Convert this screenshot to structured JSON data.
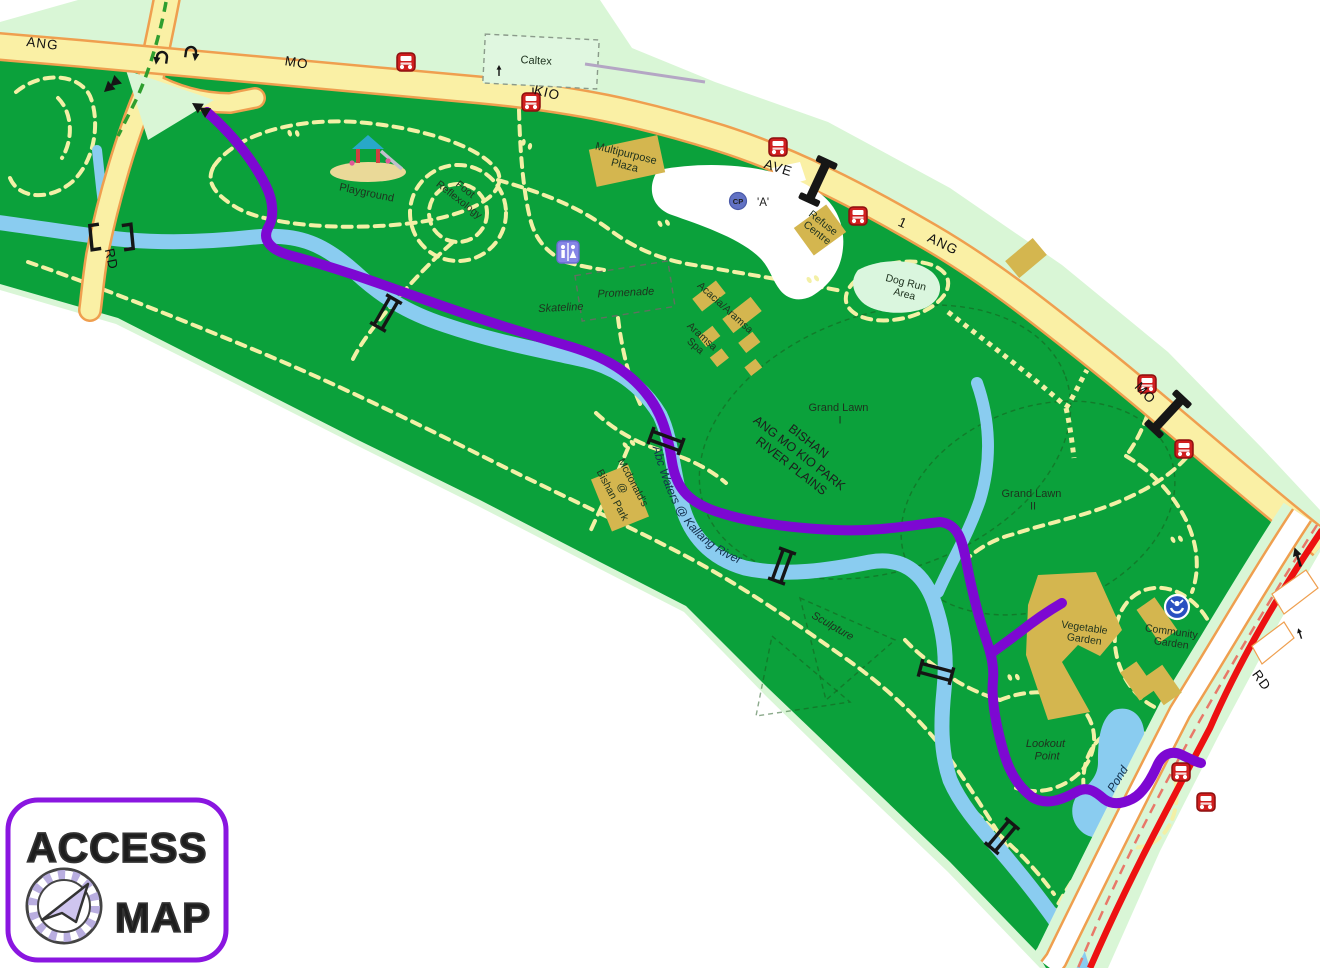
{
  "title": "Bishan - Ang Mo Kio Park access map",
  "labels": {
    "road_ang_w": "ANG",
    "road_mo_w": "MO",
    "road_kio": "KIO",
    "road_ave": "AVE",
    "road_1": "1",
    "road_ang_e": "ANG",
    "road_mo_e": "MO",
    "road_rd_w": "RD",
    "road_rd_e": "RD",
    "caltex": "Caltex",
    "playground": "Playground",
    "foot_reflexology_1": "Foot",
    "foot_reflexology_2": "Reflexology",
    "multipurpose_1": "Multipurpose",
    "multipurpose_2": "Plaza",
    "carpark_cp": "CP",
    "carpark_a": "'A'",
    "refuse_1": "Refuse",
    "refuse_2": "Centre",
    "promenade": "Promenade",
    "skateline": "Skateline",
    "acacia": "Acacia/Aramsa",
    "aramsa_1": "Aramsa",
    "aramsa_2": "Spa",
    "dogrun_1": "Dog Run",
    "dogrun_2": "Area",
    "grand_lawn_1a": "Grand Lawn",
    "grand_lawn_1b": "I",
    "bishan_1": "BISHAN",
    "bishan_2": "ANG MO KIO PARK",
    "bishan_3": "RIVER PLAINS",
    "mcd_1": "Mcdonald's",
    "mcd_2": "@",
    "mcd_3": "Bishan Park",
    "abc_waters": "Abc Waters @ Kallang River",
    "grand_lawn_2a": "Grand Lawn",
    "grand_lawn_2b": "II",
    "sculpture": "Sculpture",
    "vegetable_1": "Vegetable",
    "vegetable_2": "Garden",
    "community_1": "Community",
    "community_2": "Garden",
    "lookout_1": "Lookout",
    "lookout_2": "Point",
    "pond": "Pond"
  },
  "logo": {
    "line1": "ACCESS",
    "line2": "MAP"
  },
  "icons": {
    "bus_stop": "bus-icon",
    "toilet": "toilet-icon",
    "carpark": "carpark-cp-icon",
    "community_garden": "gardener-icon",
    "playground": "playground-icon",
    "footbridge": "bridge-icon",
    "overhead_bridge": "overhead-bridge-icon",
    "u_turn": "u-turn-arrow-icon",
    "one_way": "one-way-arrow-icon",
    "footprints": "footprints-icon"
  },
  "colors": {
    "park_green": "#0ba13b",
    "verge_green": "#d9f6d6",
    "path_yellow": "#f3f0a6",
    "road_fill": "#faf0a5",
    "road_casing": "#ef9f4f",
    "river_blue": "#8accf0",
    "route_purple": "#7d08d2",
    "bus_route_red": "#ed1111",
    "building_tan": "#d4b64f",
    "logo_purple": "#8a16e0"
  }
}
